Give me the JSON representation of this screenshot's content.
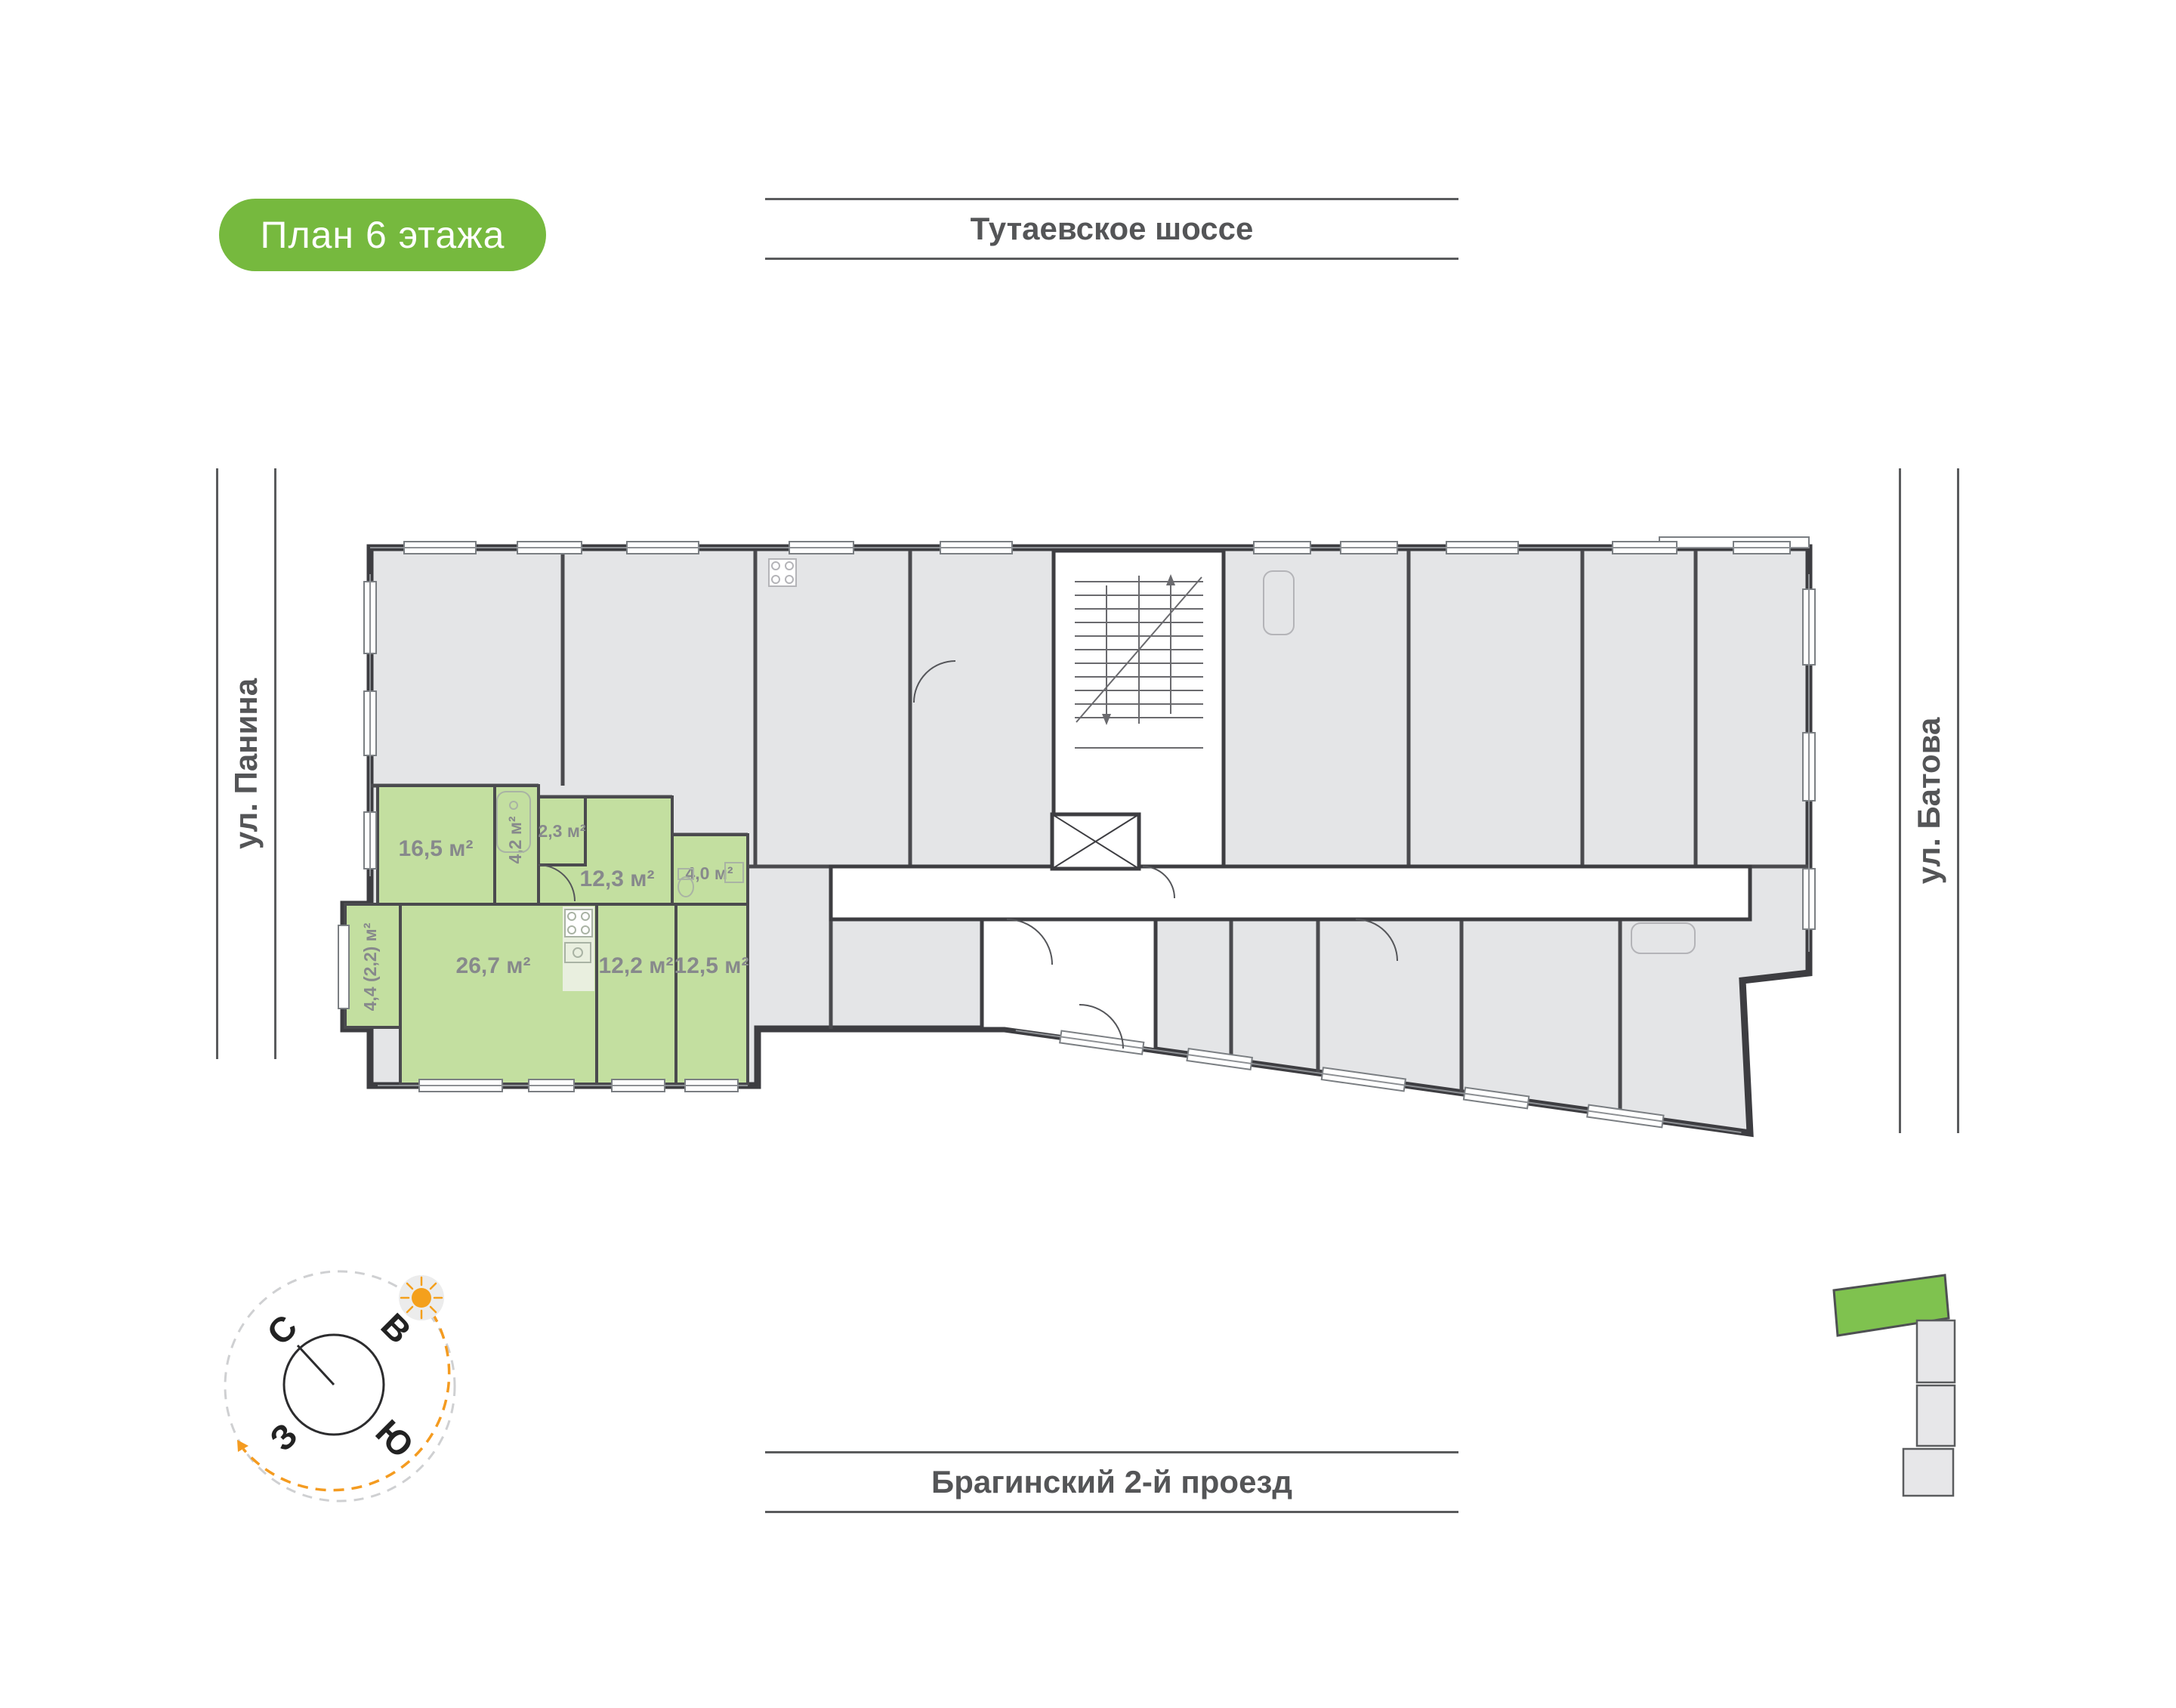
{
  "badge": {
    "label": "План 6 этажа"
  },
  "streets": {
    "top": "Тутаевское шоссе",
    "bottom": "Брагинский 2-й проезд",
    "left": "ул. Панина",
    "right": "ул. Батова"
  },
  "compass": {
    "north": "С",
    "east": "В",
    "south": "Ю",
    "west": "З"
  },
  "floor_plan": {
    "highlighted_apartment": {
      "rooms": [
        {
          "name": "room-16-5",
          "area": "16,5 м²"
        },
        {
          "name": "bathroom-4-2",
          "area": "4,2 м²"
        },
        {
          "name": "hall-2-3",
          "area": "2,3 м²"
        },
        {
          "name": "hall-12-3",
          "area": "12,3 м²"
        },
        {
          "name": "bathroom-4-0",
          "area": "4,0 м²"
        },
        {
          "name": "kitchen-living-26-7",
          "area": "26,7 м²"
        },
        {
          "name": "bedroom-12-2",
          "area": "12,2 м²"
        },
        {
          "name": "bedroom-12-5",
          "area": "12,5 м²"
        },
        {
          "name": "balcony-4-4",
          "area": "4,4 (2,2) м²"
        }
      ]
    }
  },
  "colors": {
    "accent_green": "#76b93e",
    "apartment_green": "#c3dfa0",
    "sitemap_green": "#7fc24f",
    "walls": "#3d3d41",
    "rooms_gray": "#e4e5e7",
    "compass_orange": "#f49b20"
  }
}
